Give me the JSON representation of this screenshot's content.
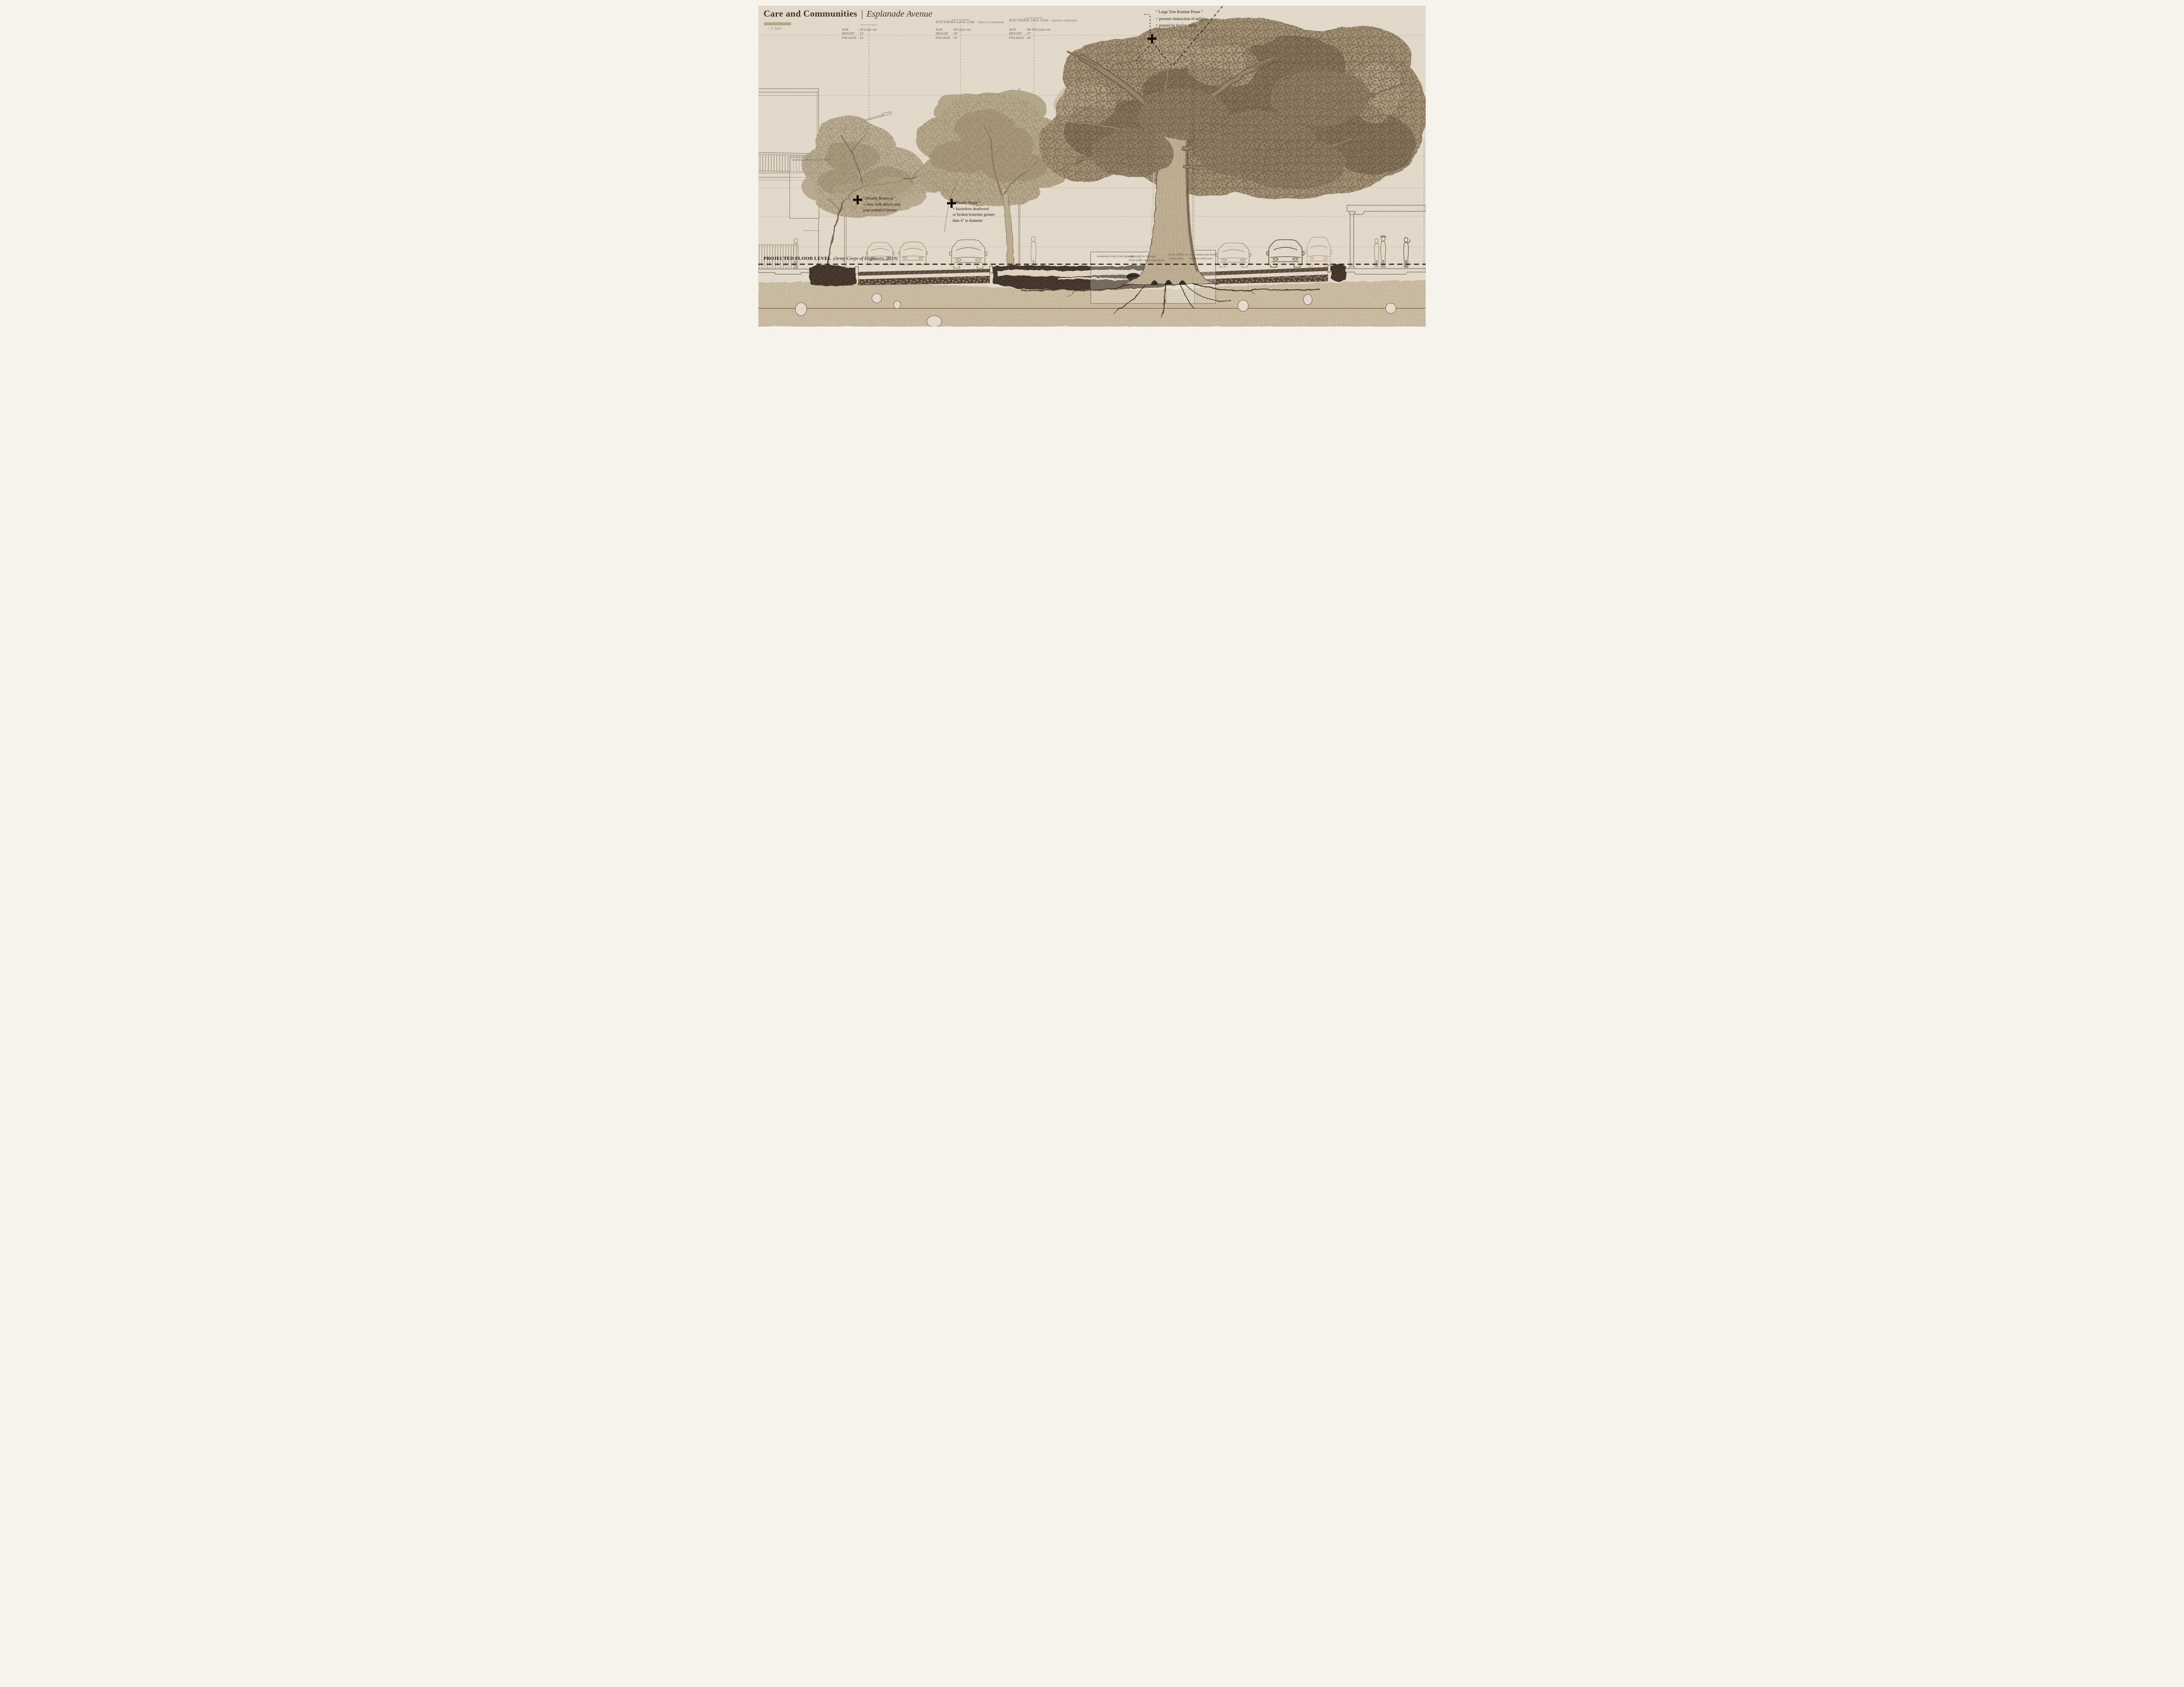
{
  "header": {
    "title_main": "Care and Communities",
    "title_divider": "|",
    "title_street": "Esplanade Avenue",
    "scale_label": "- 5 feet -"
  },
  "tree_tables": {
    "t1": {
      "age_label": "AGE",
      "age_value": ": 20 years est.",
      "height_label": "HEIGHT",
      "height_value": ": 25'",
      "foliage_label": "FOLIAGE",
      "foliage_value": ": 22'"
    },
    "t2": {
      "species": "SOUTHERN LIVE OAK",
      "species_sep": "-",
      "latin": "Quercus virginiana",
      "age_label": "AGE",
      "age_value": ": 20 years est.",
      "height_label": "HEIGHT",
      "height_value": ": 30'",
      "foliage_label": "FOLIAGE",
      "foliage_value": ": 25'"
    },
    "t3": {
      "species": "SOUTHERN LIVE OAK",
      "species_sep": "-",
      "latin": "Quercus virginiana",
      "age_label": "AGE",
      "age_value": ": 80-100 years est.",
      "height_label": "HEIGHT",
      "height_value": ": 47'",
      "foliage_label": "FOLIAGE",
      "foliage_value": ": 64'"
    }
  },
  "annotations": {
    "priority_removal": {
      "heading": "“ Priority Removal ”",
      "line1": "+ trees with defects that",
      "line2": "pose potential threats"
    },
    "priority_prune": {
      "heading": "“ Priority Prune ”",
      "line1": "+ hazardous deadwood",
      "line2": "or broken branches greater",
      "line3": "than 4\" in diameter"
    },
    "routine_prune": {
      "heading": "“ Large Tree Routine Prune ”",
      "line1": "+ prevent obstruction of utilities.",
      "line2": "+ pruned by bucket truck"
    },
    "canopy_box_label": "Limited Canopy Growth Space"
  },
  "flood_level": {
    "label": "PROJECTED FLOOD LEVEL",
    "source": "(Army Corps of Engineers, 2019)"
  },
  "root_notes": {
    "weakened": "weakened roots from damage",
    "vulnerable_line1": "vulnerable to damage",
    "vulnerable_line2": "from traffic and maintenance",
    "retain_line1": "lower ability to",
    "retain_line2": "retain water",
    "compaction_line1": "soil compaction from",
    "compaction_line2": "frequent urban use"
  },
  "colors": {
    "paper": "#e9e0d2",
    "margin": "#f6f3ec",
    "ink": "#21170e",
    "sketch_light": "#9a8a72",
    "foliage_light": "#b5a78a",
    "foliage_dark": "#77674f",
    "soil_dark": "#372b20",
    "subsoil": "#d4c6ac",
    "asphalt": "#5b4836",
    "scale_bar": "#b4a68b"
  }
}
